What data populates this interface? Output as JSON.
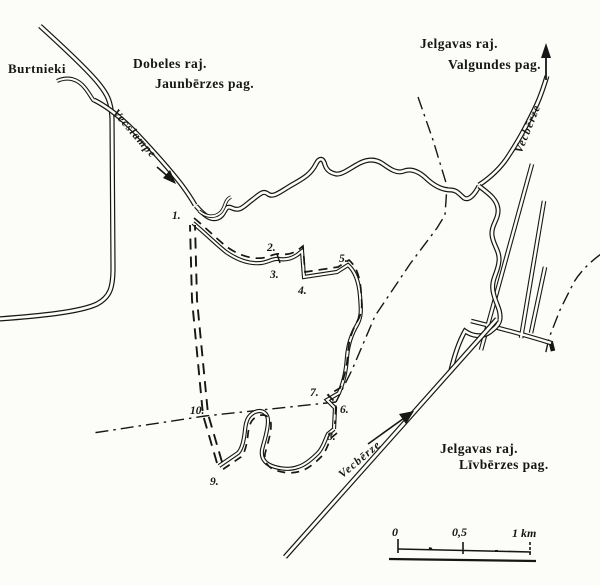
{
  "map": {
    "colors": {
      "ink": "#161616",
      "paper": "#fcfcf9"
    },
    "labels": {
      "settlement": "Burtnieki",
      "nw_district": "Dobeles raj.",
      "nw_parish": "Jaunbērzes pag.",
      "ne_district": "Jelgavas raj.",
      "ne_parish": "Valgundes pag.",
      "se_district": "Jelgavas raj.",
      "se_parish": "Līvbērzes pag.",
      "river_vecslampe": "Vecslampe",
      "river_vecberze_upper": "Vecbērze",
      "river_vecberze_lower": "Vecbērze"
    },
    "boundary_points": [
      "1.",
      "2.",
      "3.",
      "4.",
      "5.",
      "6.",
      "7.",
      "8.",
      "9.",
      "10."
    ],
    "scale_bar": {
      "zero": "0",
      "half": "0,5",
      "one": "1 km"
    }
  }
}
